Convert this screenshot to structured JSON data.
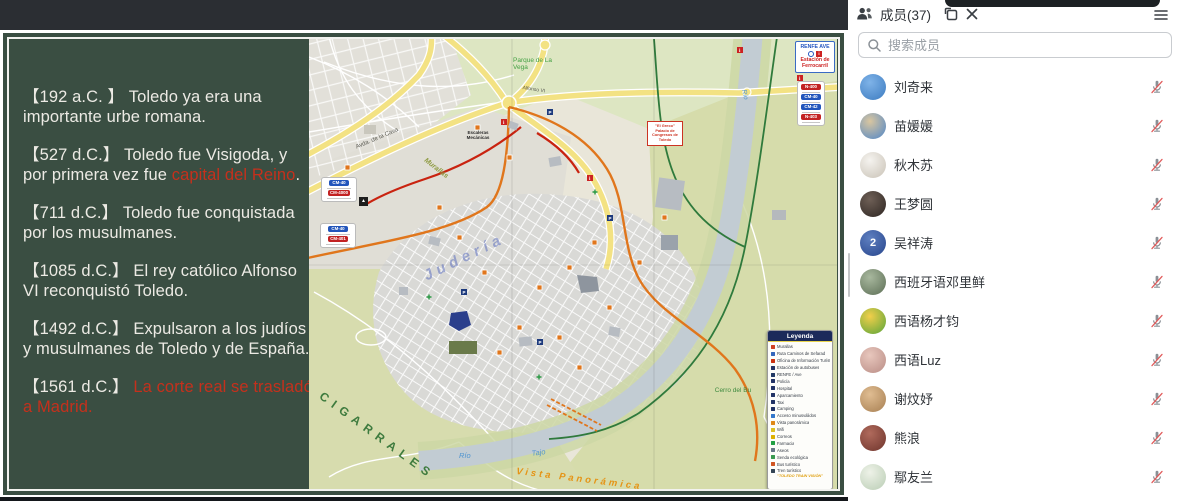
{
  "slide": {
    "bg_color": "#3a4e42",
    "red_color": "#c5301c",
    "paragraphs": [
      {
        "white1": "【192 a.C. 】 Toledo ya era una importante urbe romana.",
        "red": "",
        "white2": ""
      },
      {
        "white1": "【527 d.C.】 Toledo fue Visigoda, y por primera vez fue ",
        "red": "capital del Reino",
        "white2": "."
      },
      {
        "white1": "【711 d.C.】 Toledo fue conquistada por los musulmanes.",
        "red": "",
        "white2": ""
      },
      {
        "white1": "【1085 d.C.】 El rey católico Alfonso VI reconquistó Toledo.",
        "red": "",
        "white2": ""
      },
      {
        "white1": "【1492 d.C.】 Expulsaron a los judíos y musulmanes de Toledo y de España.",
        "red": "",
        "white2": ""
      },
      {
        "white1": "【1561 d.C.】 ",
        "red": "La corte real se trasladó a Madrid.",
        "white2": ""
      }
    ]
  },
  "map": {
    "labels": {
      "cigarrales": "CIGARRALES",
      "vista_panoramica": "Vista Panorámica",
      "rio": "Río",
      "tajo": "Tajo",
      "rio_vertical": "Río",
      "cerro_del_bu": "Cerro del Bu",
      "parque_la_vega": "Parque de La Vega",
      "juderia": "Judería",
      "murallas": "Murallas",
      "avda_cava": "Avda. de la Cava",
      "alfonso_vi": "Alfonso VI",
      "escaleras": "Escaleras Mecánicas",
      "greco_callout": "\"El Greco\" Palacio de Congresos de Toledo",
      "camping_glyph": "▲"
    },
    "station_box": {
      "line1": "RENFE AVE",
      "info_glyph": "i",
      "line2": "Estación de",
      "line3": "Ferrocarril"
    },
    "signs_right": [
      {
        "label": "N-400",
        "color": "#c22222"
      },
      {
        "label": "CM-40",
        "color": "#2255bb"
      },
      {
        "label": "CM-42",
        "color": "#2255bb"
      },
      {
        "label": "N-403",
        "color": "#c22222"
      }
    ],
    "signs_left1": [
      {
        "label": "CM-40",
        "color": "#2255bb"
      },
      {
        "label": "CM-4000",
        "color": "#c22222"
      }
    ],
    "signs_left2": [
      {
        "label": "CM-40",
        "color": "#2255bb"
      },
      {
        "label": "CM-401",
        "color": "#c22222"
      }
    ],
    "legend": {
      "title": "Leyenda",
      "footer": "\"TOLEDO TRAIN VISIÓN\"",
      "items": [
        {
          "label": "Murallas",
          "color": "#d04022"
        },
        {
          "label": "Ruta Caminos de Sefarad",
          "color": "#3366bb"
        },
        {
          "label": "Oficina de Información Turística",
          "color": "#cc3311"
        },
        {
          "label": "Estación de autobuses",
          "color": "#223366"
        },
        {
          "label": "RENFE / Ave",
          "color": "#223a66"
        },
        {
          "label": "Policía",
          "color": "#223366"
        },
        {
          "label": "Hospital",
          "color": "#223366"
        },
        {
          "label": "Aparcamiento",
          "color": "#223366"
        },
        {
          "label": "Taxi",
          "color": "#223366"
        },
        {
          "label": "Camping",
          "color": "#223366"
        },
        {
          "label": "Acceso minusválidos",
          "color": "#3377cc"
        },
        {
          "label": "Vista panorámica",
          "color": "#e08818"
        },
        {
          "label": "Wifi",
          "color": "#ddc022"
        },
        {
          "label": "Correos",
          "color": "#ddb000"
        },
        {
          "label": "Farmacia",
          "color": "#22a044"
        },
        {
          "label": "Aseos",
          "color": "#667788"
        },
        {
          "label": "Senda ecológica",
          "color": "#3a9a50"
        },
        {
          "label": "Bus turístico",
          "color": "#d05522"
        },
        {
          "label": "Tren turístico",
          "color": "#334455"
        }
      ]
    }
  },
  "panel": {
    "title": "成员(37)",
    "search_placeholder": "搜索成员",
    "mic_muted_color": "#e15b5b",
    "members": [
      {
        "name": "刘奇来",
        "av1": "#7fb3e8",
        "av2": "#3c7bc0",
        "glyph": ""
      },
      {
        "name": "苗媛媛",
        "av1": "#d9c6a0",
        "av2": "#4f86c8",
        "glyph": ""
      },
      {
        "name": "秋木苏",
        "av1": "#f5f3ef",
        "av2": "#c9c2b6",
        "glyph": ""
      },
      {
        "name": "王梦圆",
        "av1": "#6e5f56",
        "av2": "#2e2622",
        "glyph": ""
      },
      {
        "name": "吴祥涛",
        "av1": "#5e7fc0",
        "av2": "#27458c",
        "glyph": "2"
      },
      {
        "name": "西班牙语邓里鲜",
        "av1": "#a8b89e",
        "av2": "#5c6e55",
        "glyph": ""
      },
      {
        "name": "西语杨才钧",
        "av1": "#f2cf4a",
        "av2": "#58a43a",
        "glyph": ""
      },
      {
        "name": "西语Luz",
        "av1": "#e8c7bd",
        "av2": "#b98c85",
        "glyph": ""
      },
      {
        "name": "谢炆妤",
        "av1": "#e0bd92",
        "av2": "#a77f52",
        "glyph": ""
      },
      {
        "name": "熊浪",
        "av1": "#b06a5c",
        "av2": "#6e342c",
        "glyph": ""
      },
      {
        "name": "鄢友兰",
        "av1": "#eef2e8",
        "av2": "#b9cdb4",
        "glyph": ""
      }
    ]
  }
}
